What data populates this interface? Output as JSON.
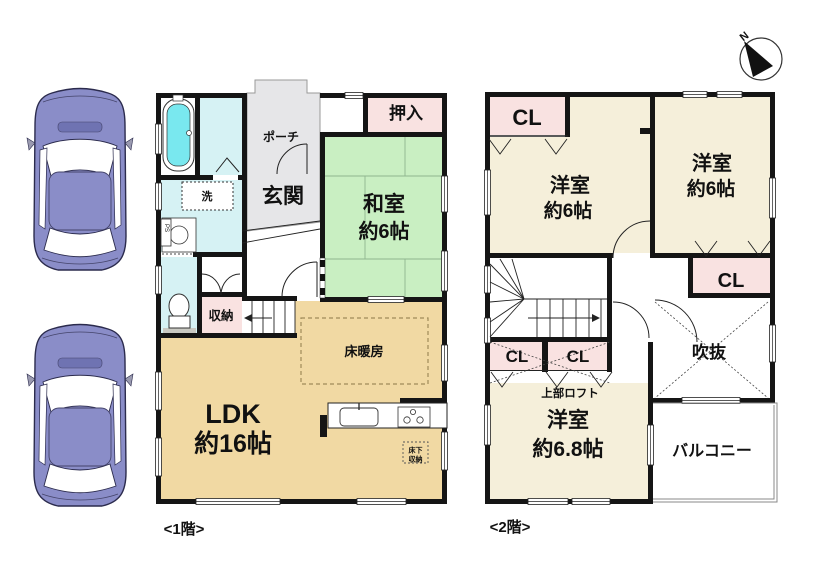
{
  "compass": {
    "north": "N"
  },
  "colors": {
    "wall": "#151515",
    "tatami": "#c9efc2",
    "cream": "#f5efda",
    "pink": "#f9e2e1",
    "tan": "#f1d9a3",
    "bath": "#d6f2f4",
    "water": "#79e8ef",
    "gray": "#e6e6e8",
    "mat": "#c9c9c2",
    "car": "#8a8dc8",
    "car_accent": "#6f73b2"
  },
  "floor1": {
    "label": "<1階>",
    "porch": "ポーチ",
    "entrance": "玄関",
    "oshiire": "押入",
    "washitsu_name": "和室",
    "washitsu_size": "約6帖",
    "laundry": "洗",
    "ps": "PS",
    "storage": "収納",
    "floor_heating": "床暖房",
    "ldk_name": "LDK",
    "ldk_size": "約16帖",
    "underfloor_line1": "床下",
    "underfloor_line2": "収納"
  },
  "floor2": {
    "label": "<2階>",
    "cl_top_left": "CL",
    "cl_mid_right": "CL",
    "cl_small_1": "CL",
    "cl_small_2": "CL",
    "room_left_name": "洋室",
    "room_left_size": "約6帖",
    "room_right_name": "洋室",
    "room_right_size": "約6帖",
    "room_bottom_name": "洋室",
    "room_bottom_size": "約6.8帖",
    "loft": "上部ロフト",
    "void": "吹抜",
    "balcony": "バルコニー"
  }
}
